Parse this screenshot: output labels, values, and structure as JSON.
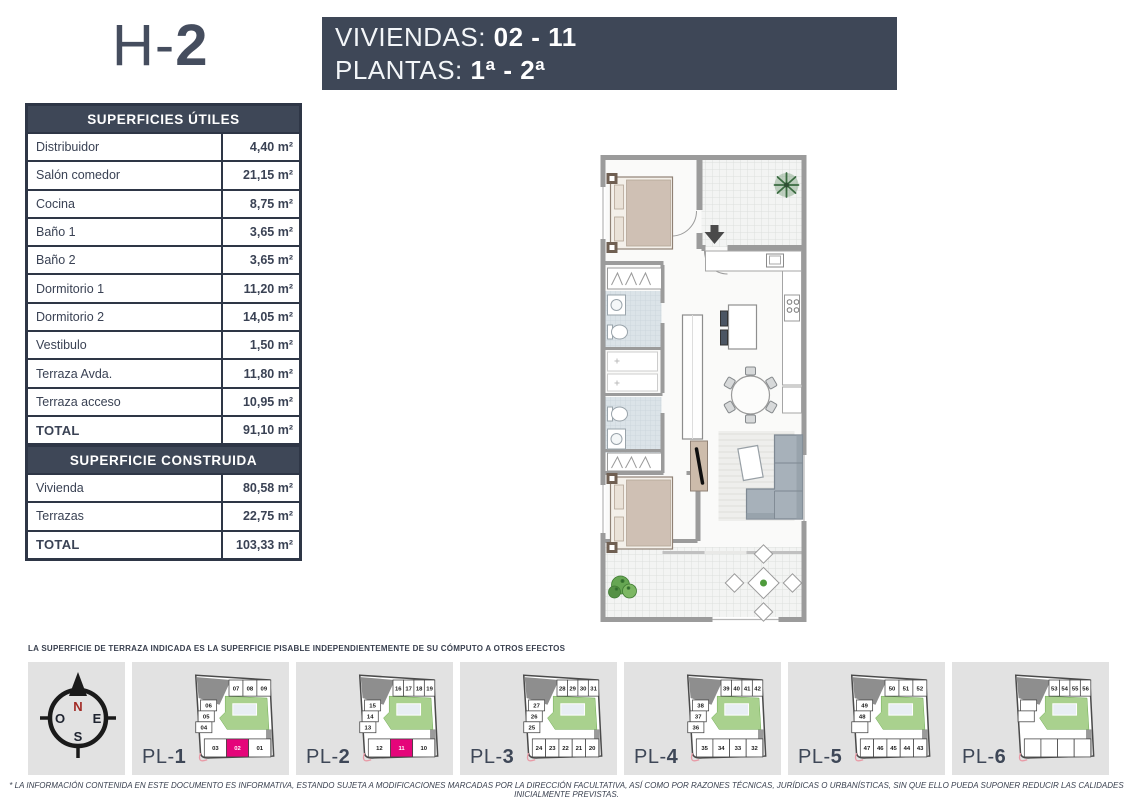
{
  "header": {
    "title_prefix": "H-",
    "title_number": "2",
    "banner": {
      "line1_label": "VIVIENDAS: ",
      "line1_value": "02 - 11",
      "line2_label": "PLANTAS: ",
      "line2_value": "1ª - 2ª"
    }
  },
  "tables": {
    "utiles": {
      "title": "SUPERFICIES ÚTILES",
      "rows": [
        {
          "label": "Distribuidor",
          "value": "4,40 m²"
        },
        {
          "label": "Salón comedor",
          "value": "21,15 m²"
        },
        {
          "label": "Cocina",
          "value": "8,75 m²"
        },
        {
          "label": "Baño 1",
          "value": "3,65 m²"
        },
        {
          "label": "Baño 2",
          "value": "3,65 m²"
        },
        {
          "label": "Dormitorio 1",
          "value": "11,20 m²"
        },
        {
          "label": "Dormitorio 2",
          "value": "14,05 m²"
        },
        {
          "label": "Vestibulo",
          "value": "1,50 m²"
        },
        {
          "label": "Terraza Avda.",
          "value": "11,80 m²"
        },
        {
          "label": "Terraza acceso",
          "value": "10,95 m²"
        },
        {
          "label": "TOTAL",
          "value": "91,10 m²",
          "total": true
        }
      ]
    },
    "construida": {
      "title": "SUPERFICIE CONSTRUIDA",
      "rows": [
        {
          "label": "Vivienda",
          "value": "80,58 m²"
        },
        {
          "label": "Terrazas",
          "value": "22,75 m²"
        },
        {
          "label": "TOTAL",
          "value": "103,33 m²",
          "total": true
        }
      ]
    }
  },
  "notes": {
    "terrace_note": "LA SUPERFICIE DE TERRAZA INDICADA ES LA SUPERFICIE PISABLE INDEPENDIENTEMENTE DE SU CÓMPUTO A OTROS EFECTOS",
    "legal_note": "* LA INFORMACIÓN CONTENIDA EN ESTE DOCUMENTO ES INFORMATIVA, ESTANDO SUJETA A MODIFICACIONES MARCADAS POR LA DIRECCIÓN FACULTATIVA, ASÍ COMO POR RAZONES TÉCNICAS, JURÍDICAS O URBANÍSTICAS, SIN QUE ELLO PUEDA SUPONER REDUCIR LAS CALIDADES INICIALMENTE PREVISTAS."
  },
  "compass": {
    "north": "N",
    "west": "O",
    "east": "E",
    "south": "S"
  },
  "plans": [
    {
      "label_prefix": "PL-",
      "label_number": "1",
      "top": [
        "07",
        "08",
        "09"
      ],
      "left": [
        "06",
        "05",
        "04"
      ],
      "bottom": [
        "03",
        "02",
        "01"
      ],
      "highlight": "02"
    },
    {
      "label_prefix": "PL-",
      "label_number": "2",
      "top": [
        "16",
        "17",
        "18",
        "19"
      ],
      "left": [
        "15",
        "14",
        "13"
      ],
      "bottom": [
        "12",
        "11",
        "10"
      ],
      "highlight": "11"
    },
    {
      "label_prefix": "PL-",
      "label_number": "3",
      "top": [
        "28",
        "29",
        "30",
        "31"
      ],
      "left": [
        "27",
        "26",
        "25"
      ],
      "bottom": [
        "24",
        "23",
        "22",
        "21",
        "20"
      ],
      "highlight": ""
    },
    {
      "label_prefix": "PL-",
      "label_number": "4",
      "top": [
        "39",
        "40",
        "41",
        "42"
      ],
      "left": [
        "38",
        "37",
        "36"
      ],
      "bottom": [
        "35",
        "34",
        "33",
        "32"
      ],
      "highlight": ""
    },
    {
      "label_prefix": "PL-",
      "label_number": "5",
      "top": [
        "50",
        "51",
        "52"
      ],
      "left": [
        "49",
        "48",
        ""
      ],
      "bottom": [
        "47",
        "46",
        "45",
        "44",
        "43"
      ],
      "highlight": ""
    },
    {
      "label_prefix": "PL-",
      "label_number": "6",
      "top": [
        "53",
        "54",
        "55",
        "56"
      ],
      "left": [
        "",
        ""
      ],
      "bottom": [
        "",
        "",
        "",
        ""
      ],
      "highlight": ""
    }
  ],
  "colors": {
    "slate": "#3e4757",
    "table_border": "#2e3646",
    "magenta": "#e5057a",
    "courtyard_green": "#a9d18e",
    "thumb_bg": "#e2e2e2",
    "wall_gray": "#9b9b9b"
  }
}
